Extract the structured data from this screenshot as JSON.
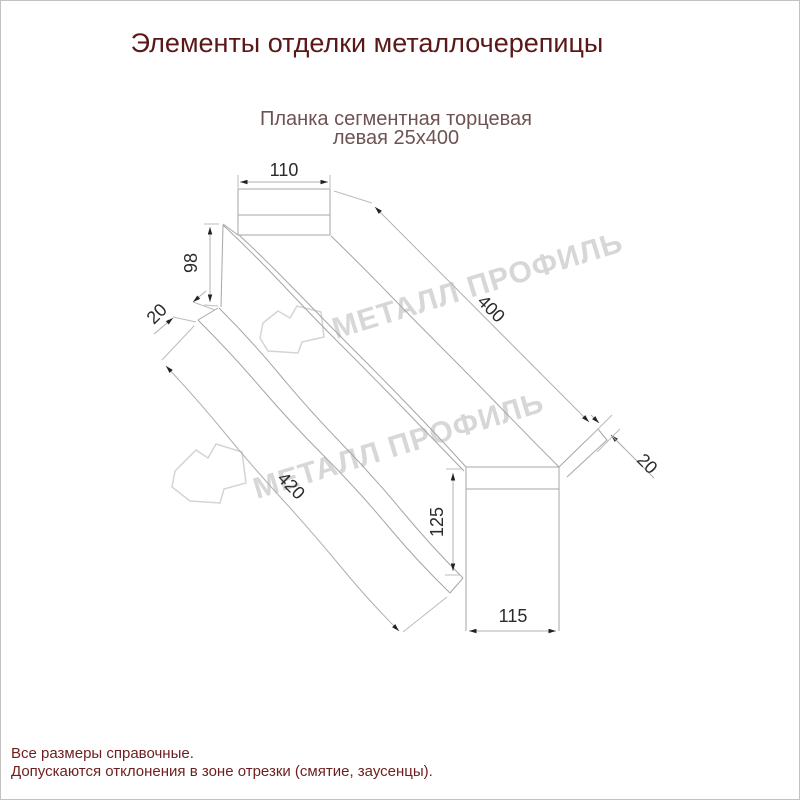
{
  "title": "Элементы отделки металлочерепицы",
  "subtitle": {
    "line1": "Планка сегментная торцевая",
    "line2": "левая 25х400"
  },
  "drawing": {
    "name": "Планка сегментная торцевая левая 25х400",
    "dimensions": {
      "top_flange_width": "110",
      "back_web_height": "98",
      "back_hem": "20",
      "top_length": "400",
      "front_flap": "20",
      "bottom_length": "420",
      "front_web_height": "125",
      "front_flange_width": "115"
    }
  },
  "watermark": {
    "text": "МЕТАЛЛ ПРОФИЛЬ",
    "color": "#d7d7d7"
  },
  "footer": {
    "line1": "Все размеры справочные.",
    "line2": "Допускаются отклонения в зоне отрезки (смятие, заусенцы)."
  },
  "colors": {
    "title": "#5a1818",
    "subtitle": "#6e5353",
    "footer": "#6e1e1e",
    "outline": "#a6a6a6",
    "dimension_text": "#2b2b2b",
    "background": "#ffffff"
  }
}
